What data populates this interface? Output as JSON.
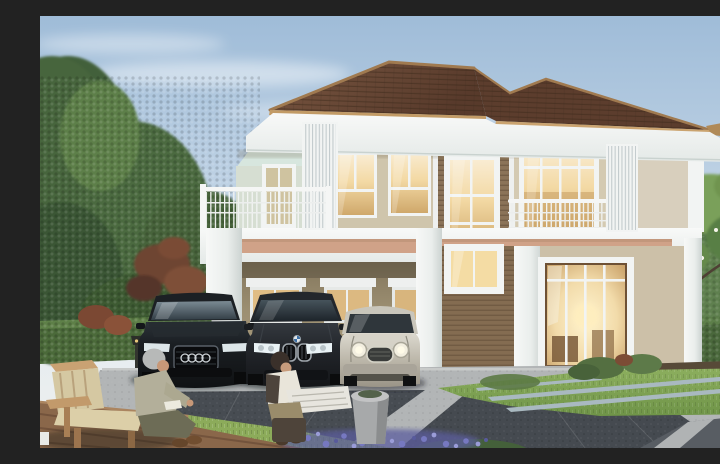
{
  "scene": {
    "type": "architectural-exterior-rendering",
    "description": "Daytime rendering of a modern two-story house with a brown hip tile roof, beige stucco and brown wood siding, white trim, a carport with three parked cars (black sedan with four-ring badge, dark gray sedan with twin-kidney grille, silver compact with round headlamps), warm glowing windows, a second-floor terrace and juliet balcony, an elderly man reading on a wooden bench with a child holding a newspaper in the left foreground, evergreen trees, trimmed hedges, a frangipani tree with white flowers, lawn, purple flower bed, timber deck and a paved driveway.",
    "text_content": "none"
  },
  "palette": {
    "sky_top": "#9FBCD8",
    "sky_horizon": "#EDF0EF",
    "roof_tile": "#64432F",
    "roof_fascia": "#C49E6A",
    "trim_white": "#F2F4F3",
    "wall_stucco": "#CFC5AC",
    "wall_siding": "#8B7358",
    "accent_band": "#D0A288",
    "carport_wall": "#A59878",
    "window_glow": "#F3D9A4",
    "hedge_green": "#4A683C",
    "lawn_green": "#86A355",
    "driveway_light": "#B2B5B6",
    "paver_dark": "#474C52",
    "deck_wood": "#8A674A",
    "flower_purple": "#7678C0"
  },
  "house": {
    "stories": 2,
    "roof": {
      "style": "hip",
      "material": "tile",
      "color": "#64432F"
    },
    "features": [
      "carport with white columns",
      "second-floor terrace with white railing",
      "juliet balcony",
      "vertical louver screens",
      "tall glazed entrance door",
      "stone entrance steps",
      "warm interior lighting in windows"
    ],
    "visible_lit_windows": 10
  },
  "vehicles": [
    {
      "position": "left",
      "body": "sedan",
      "color": "black",
      "badge": "four-rings-grille"
    },
    {
      "position": "center",
      "body": "sedan",
      "color": "dark-gray",
      "badge": "twin-kidney-grille-roundel"
    },
    {
      "position": "right",
      "body": "compact-hatchback",
      "color": "silver",
      "badge": "round-headlamps-chrome-grille"
    }
  ],
  "people": [
    {
      "label": "elderly-man",
      "activity": "sitting on wooden bench reading",
      "position": "foreground-left"
    },
    {
      "label": "child",
      "activity": "sitting on stool holding newspaper",
      "position": "foreground-left"
    }
  ],
  "landscape": {
    "left": [
      "tall evergreen trees",
      "maroon-leaf tree",
      "trimmed hedge",
      "garden lamp"
    ],
    "right": [
      "frangipani tree with white flowers",
      "tall trimmed hedge",
      "shrubs",
      "distant russet tree"
    ],
    "foreground": [
      "timber deck",
      "bright lawn strip",
      "purple flower bed",
      "gray cylindrical planter",
      "paved driveway with dark paver fields and light concrete bands"
    ]
  }
}
